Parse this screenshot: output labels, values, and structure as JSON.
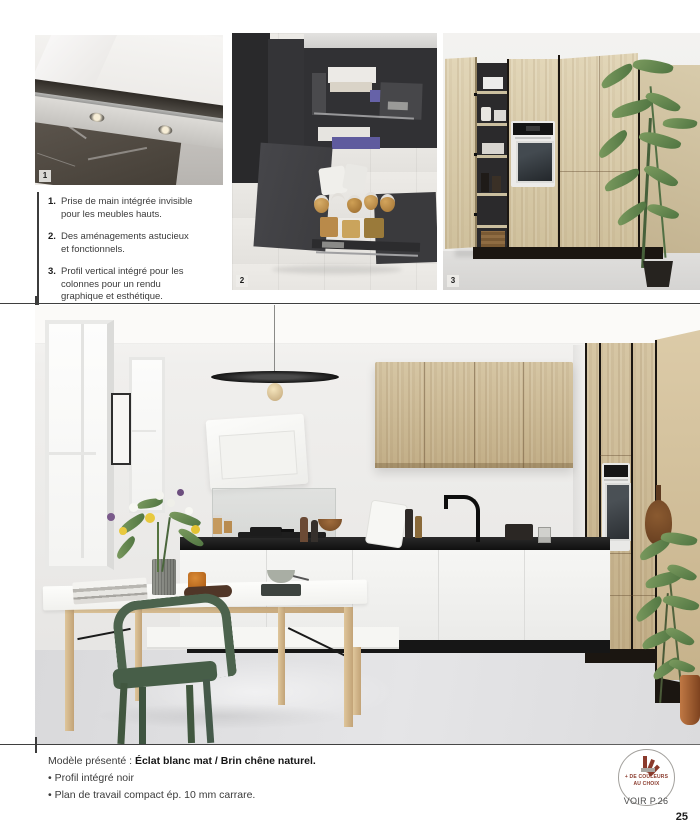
{
  "page": {
    "number": "25",
    "see_page": "VOIR P.26"
  },
  "badge": {
    "line1": "+ DE COULEURS",
    "line2": "AU CHOIX",
    "accent_color": "#8a3a2c"
  },
  "features": {
    "items": [
      {
        "num": "1.",
        "text": "Prise de main intégrée invisible pour les meubles hauts."
      },
      {
        "num": "2.",
        "text": "Des aménagements astucieux et fonctionnels."
      },
      {
        "num": "3.",
        "text": "Profil vertical intégré pour les colonnes pour un rendu graphique et esthétique."
      }
    ]
  },
  "photos": {
    "label1": "1",
    "label2": "2",
    "label3": "3"
  },
  "caption": {
    "prefix": "Modèle présenté : ",
    "model": "Éclat blanc mat / Brin chêne naturel.",
    "bullet1": "• Profil intégré noir",
    "bullet2": "• Plan de travail compact ép. 10 mm carrare."
  },
  "colors": {
    "oak": "#cdbb97",
    "anthracite": "#3a3a3c",
    "counter_black": "#1c1c1c",
    "chair_green": "#4c634d"
  }
}
